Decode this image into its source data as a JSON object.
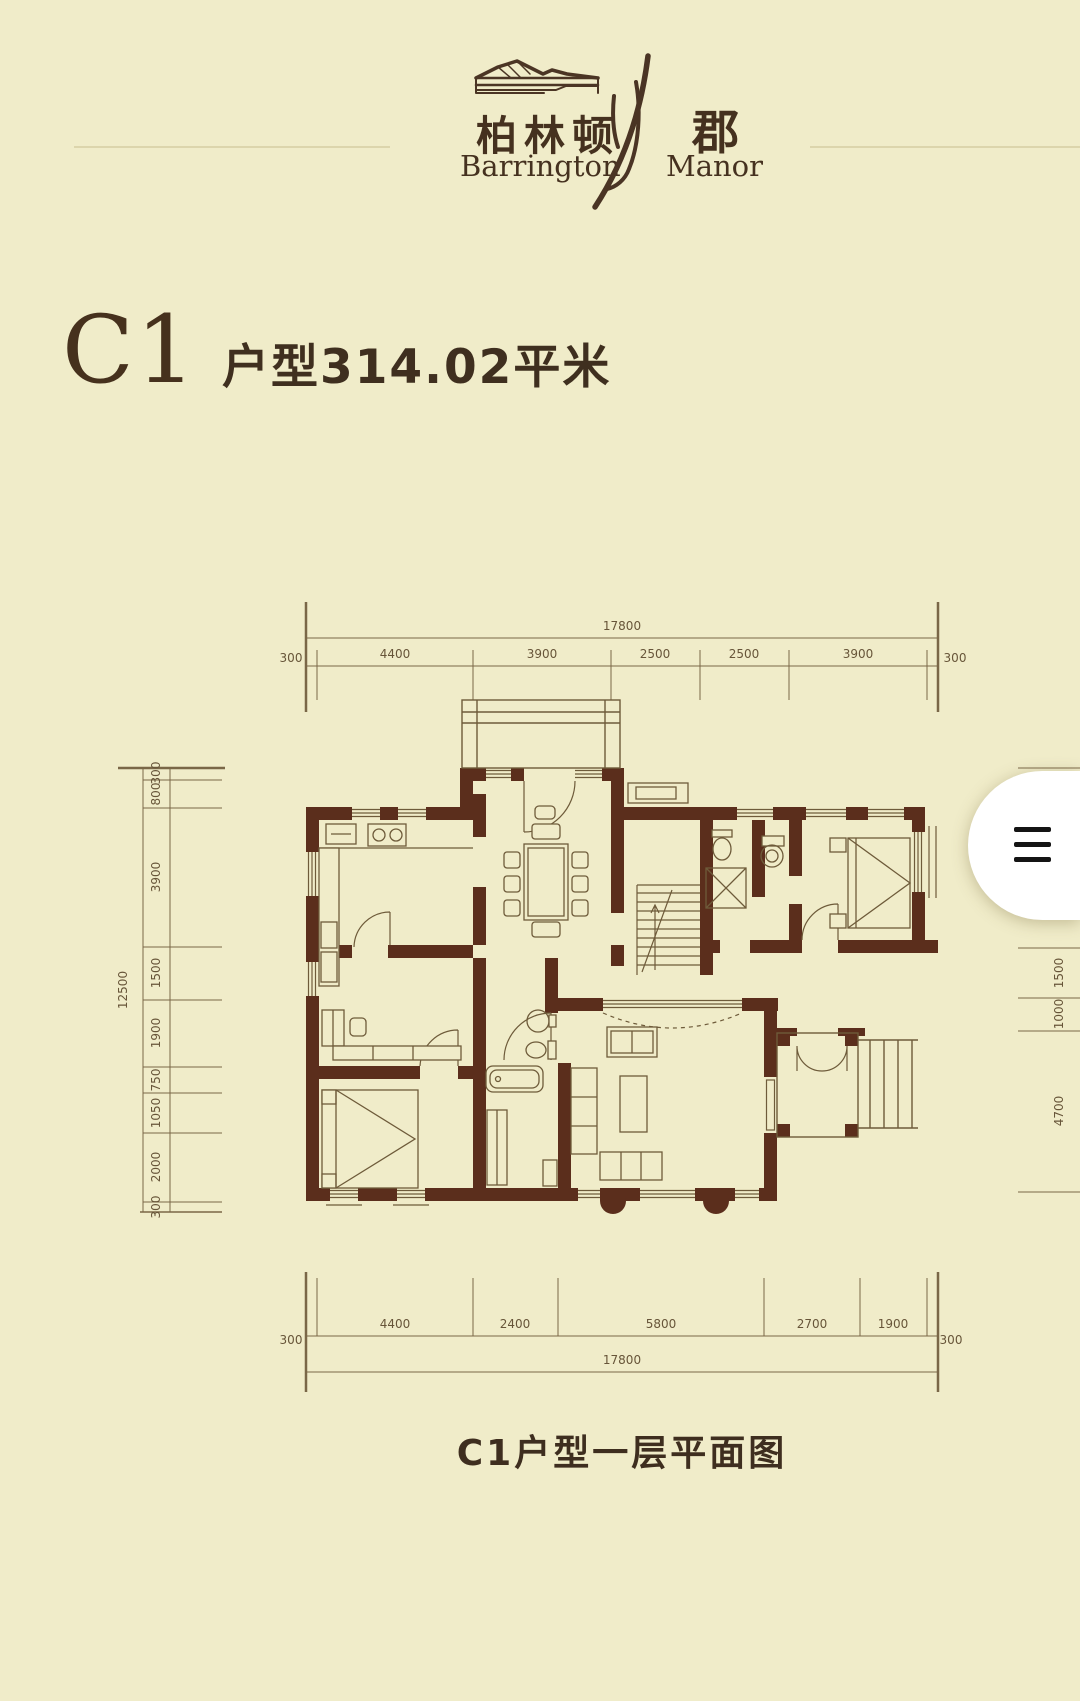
{
  "logo": {
    "cn_main": "柏林顿",
    "cn_suffix": "郡",
    "en_main": "Barrington",
    "en_suffix": "Manor"
  },
  "title": {
    "unit": "C1",
    "area": "户型314.02平米"
  },
  "caption": "C1户型一层平面图",
  "dims": {
    "top": {
      "total": "17800",
      "left_end": "300",
      "right_end": "300",
      "segments": [
        "4400",
        "3900",
        "2500",
        "2500",
        "3900"
      ]
    },
    "bottom": {
      "total": "17800",
      "left_end": "300",
      "right_end": "300",
      "segments": [
        "4400",
        "2400",
        "5800",
        "2700",
        "1900"
      ]
    },
    "left": {
      "total": "12500",
      "segments": [
        "300",
        "800",
        "3900",
        "1500",
        "1900",
        "750",
        "1050",
        "2000",
        "300"
      ]
    },
    "right": {
      "segments": [
        "1500",
        "1000",
        "4700"
      ]
    }
  },
  "colors": {
    "background": "#f0ecc9",
    "wall": "#5b2e1c",
    "thin_line": "#6e5b3a",
    "dim_line": "#7a6747",
    "dim_text": "#675539",
    "title_text": "#46311d",
    "menu_bar": "#141414"
  }
}
